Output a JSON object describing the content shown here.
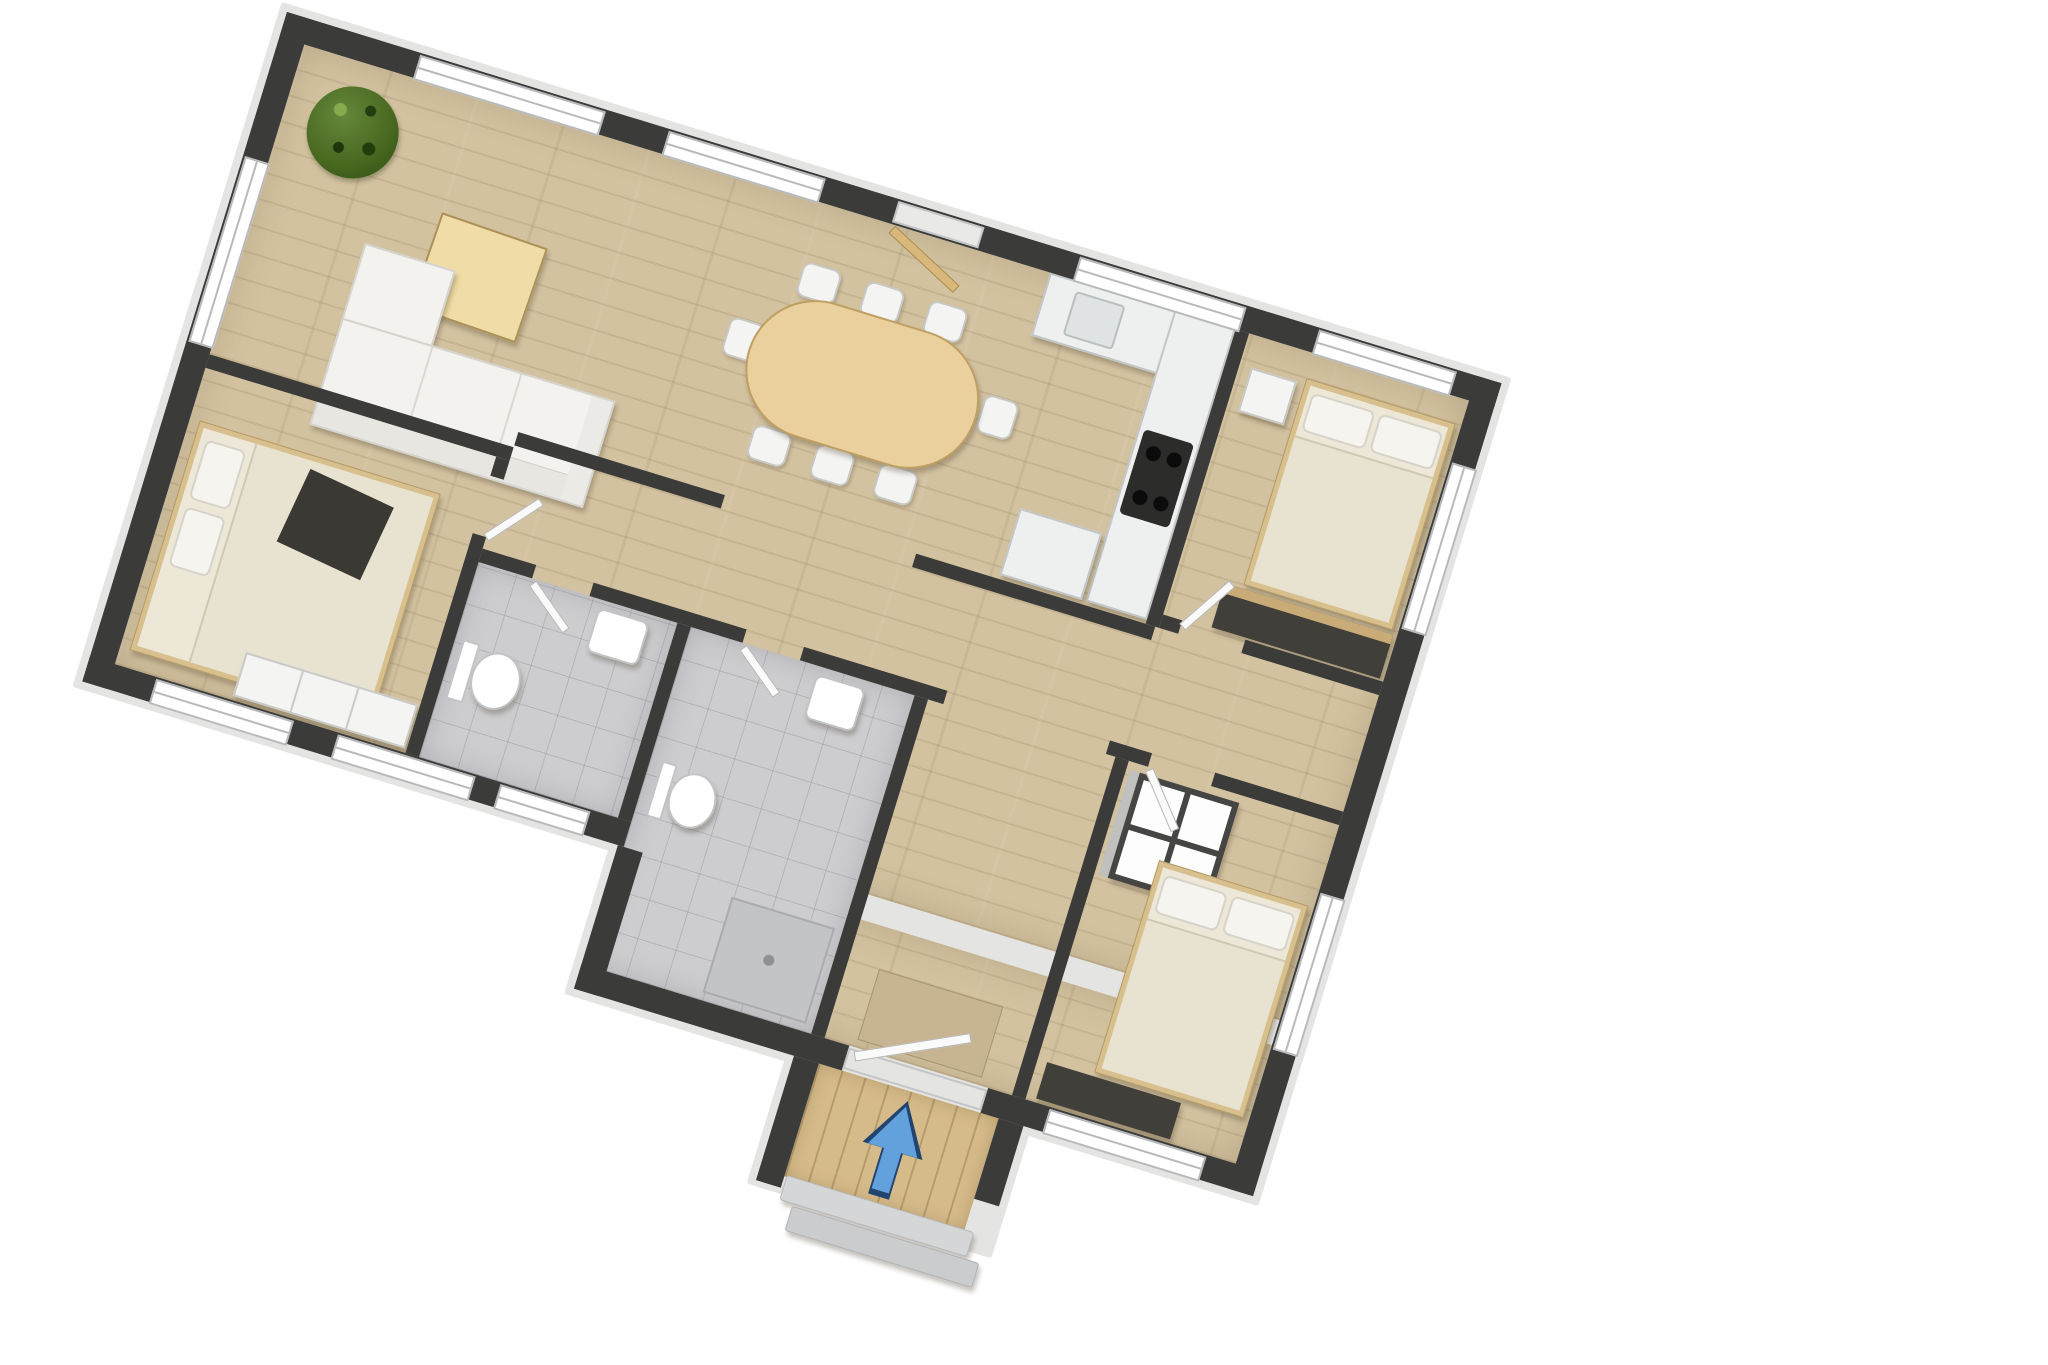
{
  "scene": {
    "type": "3d-floor-plan-top-view",
    "rotation_deg": 17,
    "background": "#ffffff",
    "text_labels": []
  },
  "colors": {
    "wall": "#3b3b39",
    "wall_trim": "#e4e4e3",
    "wood": "#d3c2a0",
    "tile": "#cdcdd0",
    "deck": "#d6bb8a",
    "window": "#ffffff",
    "window_frame": "#b7b9bb",
    "door_leaf": "#fafafa",
    "door_tan": "#d9b87c",
    "counter": "#eef0f0",
    "counter_edge": "#c2c6c6",
    "cooktop": "#2c2c2a",
    "table_wood": "#ead09d",
    "table_edge": "#bf9f62",
    "coffee": "#f0dca6",
    "sofa": "#f3f2ef",
    "bed_frame": "#d8c08e",
    "mattress": "#ece7d7",
    "duvet": "#e8e2d0",
    "pillow": "#f6f4ee",
    "plant": "#47661f",
    "white_furn": "#f4f4f2",
    "dark_furn": "#413f39",
    "mat": "#c6b492",
    "step": "#d5d6d8",
    "shower": "#c3c4c7",
    "arrow": "#63a1dc",
    "arrow_edge": "#22456f"
  },
  "rooms": [
    {
      "name": "living-room",
      "floor": "wood"
    },
    {
      "name": "dining-area",
      "floor": "wood"
    },
    {
      "name": "kitchen",
      "floor": "wood"
    },
    {
      "name": "bedroom-top-right",
      "floor": "wood"
    },
    {
      "name": "bedroom-bottom-right",
      "floor": "wood"
    },
    {
      "name": "bedroom-left",
      "floor": "wood"
    },
    {
      "name": "wc",
      "floor": "tile"
    },
    {
      "name": "bathroom",
      "floor": "tile"
    },
    {
      "name": "hallway",
      "floor": "wood"
    },
    {
      "name": "entry-hall",
      "floor": "wood"
    },
    {
      "name": "porch",
      "floor": "deck"
    }
  ],
  "furniture_inventory": [
    "potted-plant",
    "coffee-table",
    "sofa-with-chaise",
    "oval-dining-table",
    "eight-dining-chairs",
    "l-shaped-kitchen-counter",
    "kitchen-sink",
    "cooktop-4-burners",
    "kitchen-island",
    "double-bed-top-right",
    "nightstand",
    "wardrobe-dark",
    "double-bed-bottom-right",
    "cube-shelf",
    "dark-dresser",
    "double-bed-left",
    "wardrobe-white",
    "toilet-wc",
    "washbasin-wc",
    "toilet-bathroom",
    "washbasin-bathroom",
    "shower-tray",
    "entry-mat",
    "porch-deck",
    "two-steps",
    "entry-direction-arrow"
  ],
  "entry_arrow": {
    "meaning": "entrance-direction",
    "color": "#63a1dc",
    "points": "into-house"
  }
}
